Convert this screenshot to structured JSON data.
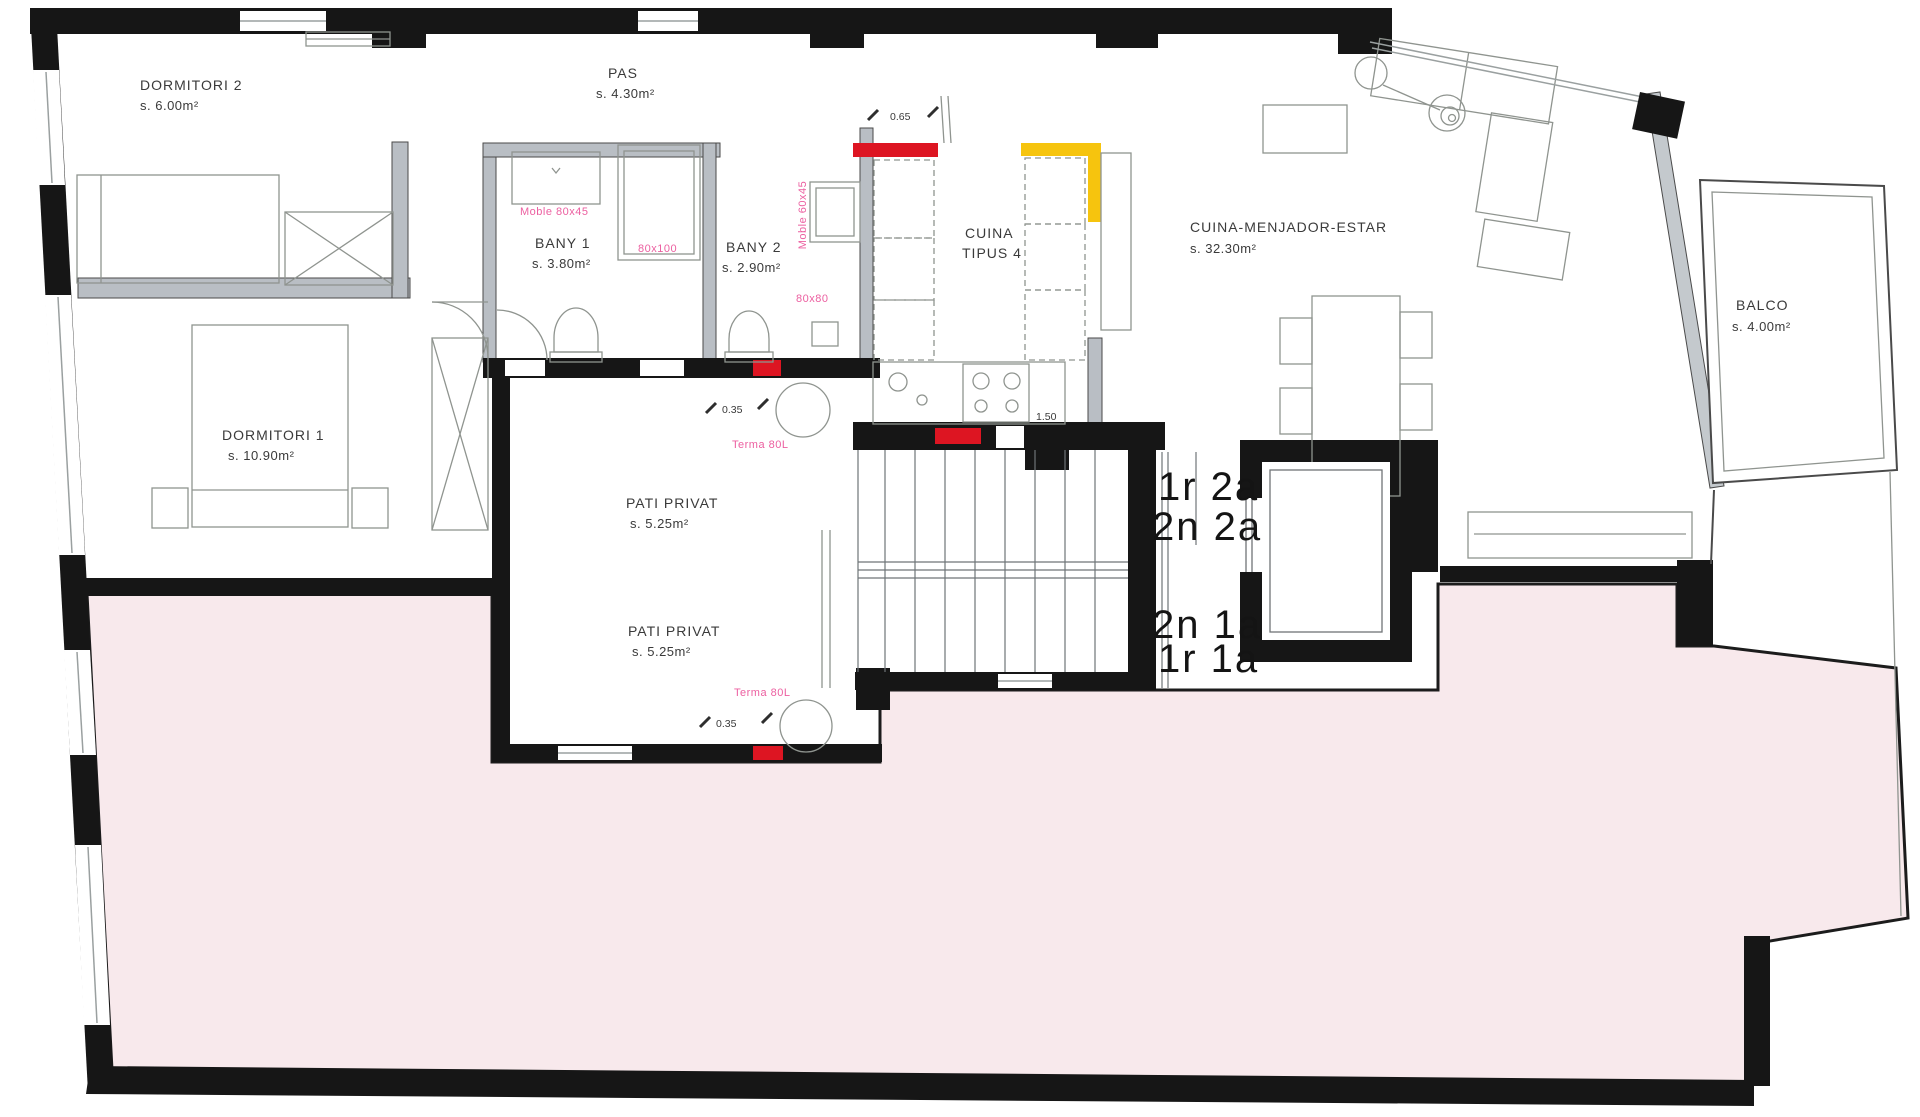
{
  "plan": {
    "title": "Apartment floor plan (scanned architectural drawing)",
    "rooms": {
      "dormitori2": {
        "name": "DORMITORI 2",
        "area": "s. 6.00m²"
      },
      "pas": {
        "name": "PAS",
        "area": "s. 4.30m²"
      },
      "bany1": {
        "name": "BANY 1",
        "area": "s. 3.80m²"
      },
      "bany2": {
        "name": "BANY 2",
        "area": "s. 2.90m²"
      },
      "cuina": {
        "name": "CUINA",
        "type": "TIPUS 4"
      },
      "cuina_menjador_estar": {
        "name": "CUINA-MENJADOR-ESTAR",
        "area": "s. 32.30m²"
      },
      "balco": {
        "name": "BALCO",
        "area": "s. 4.00m²"
      },
      "dormitori1": {
        "name": "DORMITORI 1",
        "area": "s. 10.90m²"
      },
      "pati_privat_1": {
        "name": "PATI PRIVAT",
        "area": "s. 5.25m²"
      },
      "pati_privat_2": {
        "name": "PATI PRIVAT",
        "area": "s. 5.25m²"
      }
    },
    "units": {
      "top": [
        "1r 2a",
        "2n 2a"
      ],
      "bottom": [
        "2n 1a",
        "1r 1a"
      ]
    },
    "fixtures": {
      "moble_80x45": "Moble 80x45",
      "shower_80x100": "80x100",
      "moble_60x45": "Moble 60x45",
      "shower_80x80": "80x80",
      "terma_1": "Terma 80L",
      "terma_2": "Terma 80L"
    },
    "dimensions": {
      "door_top": "0.65",
      "kitchen_run": "1.50",
      "pati_1": "0.35",
      "pati_2": "0.35"
    },
    "colors": {
      "wall": "#161616",
      "partition": "#b9bec4",
      "terrace_fill": "#f8e9ec",
      "accent_red": "#dd1522",
      "accent_yellow": "#f6c40e",
      "accent_pink_text": "#ec5fa0",
      "furniture_line": "#8f948f"
    }
  }
}
